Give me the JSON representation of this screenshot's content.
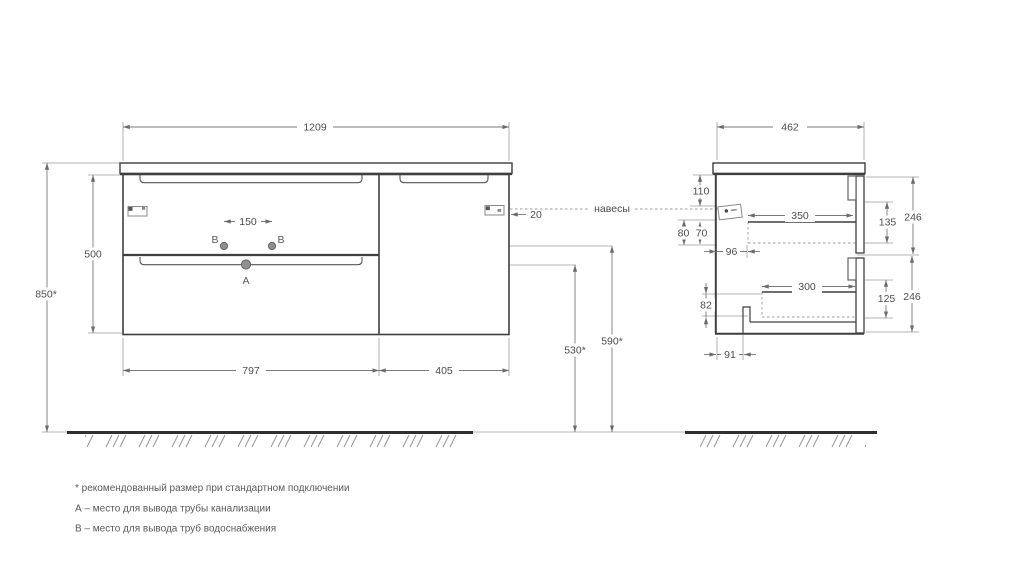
{
  "front_view": {
    "width_top": "1209",
    "height": "500",
    "wall_height": "850*",
    "b_spacing": "150",
    "left_width": "797",
    "right_width": "405",
    "drain_height": "530*",
    "supply_height": "590*",
    "bracket_gap": "20",
    "point_a": "А",
    "point_b": "В"
  },
  "side_view": {
    "depth": "462",
    "d110": "110",
    "d80": "80",
    "d70": "70",
    "d96": "96",
    "d350": "350",
    "d300": "300",
    "d82": "82",
    "d91": "91",
    "d135": "135",
    "d125": "125",
    "d246_top": "246",
    "d246_bottom": "246"
  },
  "labels": {
    "hangers": "навесы"
  },
  "footnotes": {
    "star": "* рекомендованный размер при стандартном подключении",
    "a": "А – место для вывода трубы канализации",
    "b": "В – место для вывода труб водоснабжения"
  }
}
